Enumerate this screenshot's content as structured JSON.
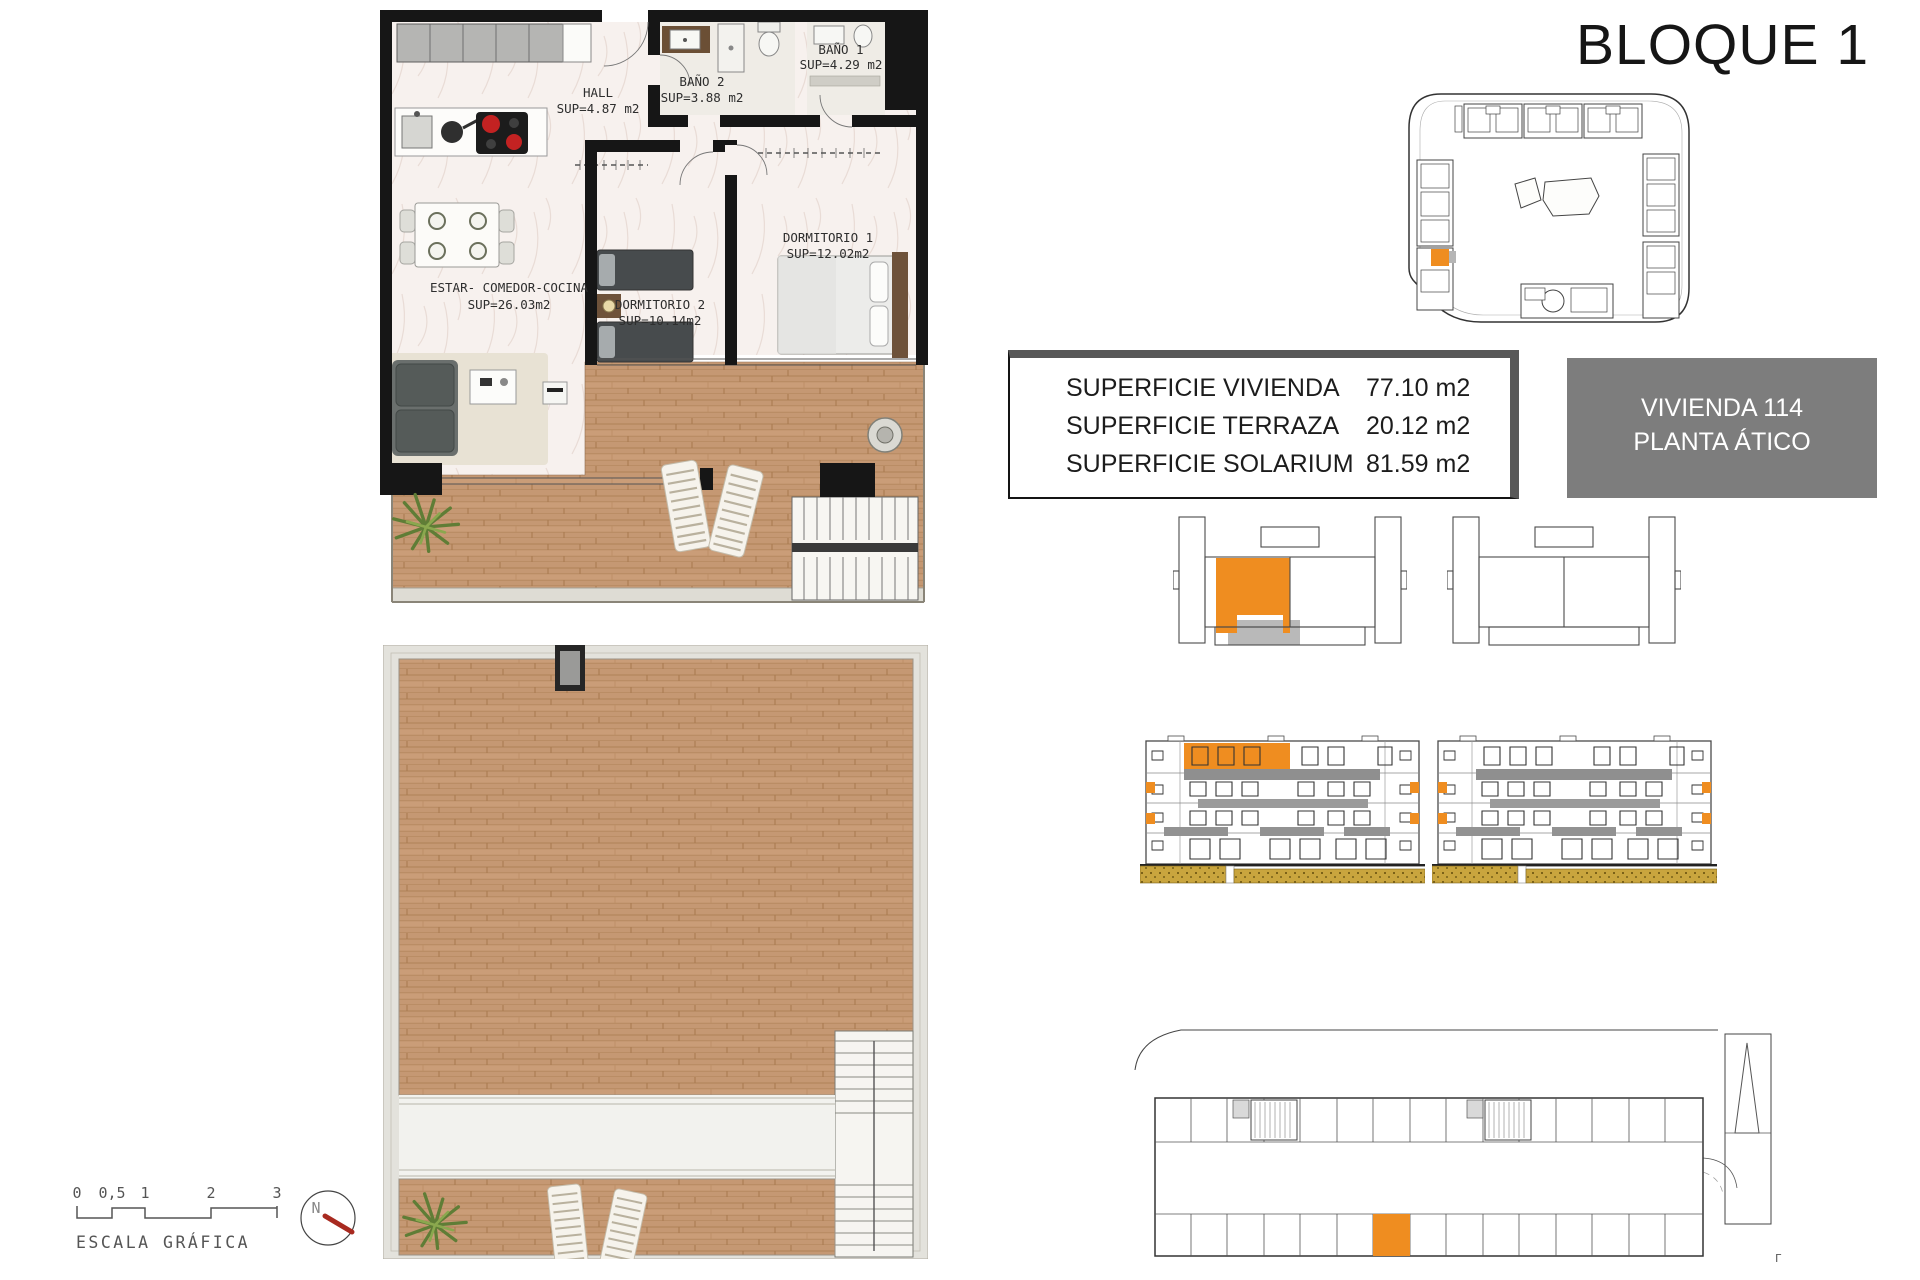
{
  "page": {
    "title": "BLOQUE 1"
  },
  "summary": {
    "rows": [
      {
        "label": "SUPERFICIE VIVIENDA",
        "value": "77.10 m2"
      },
      {
        "label": "SUPERFICIE TERRAZA",
        "value": "20.12 m2"
      },
      {
        "label": "SUPERFICIE SOLARIUM",
        "value": "81.59 m2"
      }
    ]
  },
  "unit": {
    "name": "VIVIENDA 114",
    "floor": "PLANTA ÁTICO"
  },
  "plan": {
    "rooms": {
      "estar": {
        "name": "ESTAR- COMEDOR-COCINA",
        "area": "SUP=26.03m2"
      },
      "hall": {
        "name": "HALL",
        "area": "SUP=4.87 m2"
      },
      "bano1": {
        "name": "BAÑO 1",
        "area": "SUP=4.29 m2"
      },
      "bano2": {
        "name": "BAÑO 2",
        "area": "SUP=3.88 m2"
      },
      "dorm1": {
        "name": "DORMITORIO 1",
        "area": "SUP=12.02m2"
      },
      "dorm2": {
        "name": "DORMITORIO 2",
        "area": "SUP=10.14m2"
      }
    }
  },
  "scale_bar": {
    "ticks": [
      "0",
      "0,5",
      "1",
      "2",
      "3"
    ],
    "label": "ESCALA GRÁFICA"
  },
  "compass": {
    "label": "N"
  },
  "parking": {
    "mark": "Γ"
  },
  "colors": {
    "accent": "#EF8D20",
    "unit_box_bg": "#7D7D7D",
    "ground": "#C9A53E",
    "wood": "#C59873"
  }
}
